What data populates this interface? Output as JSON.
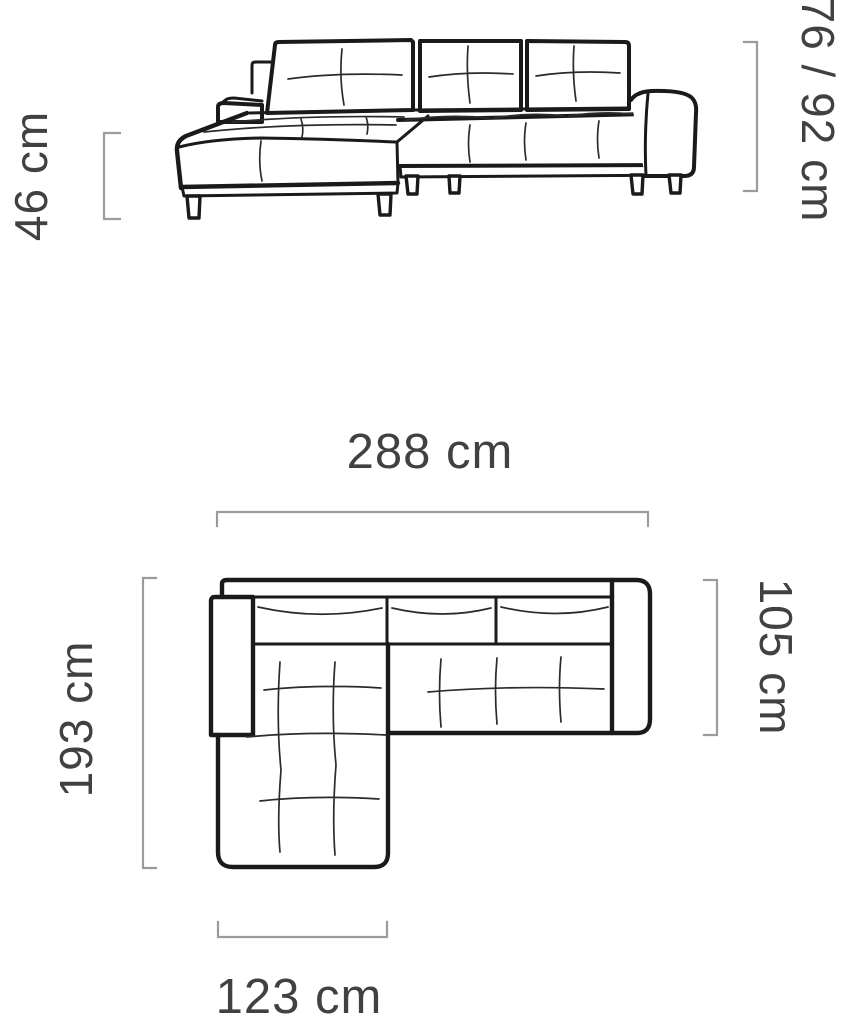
{
  "diagram": {
    "subject": "corner-sofa-dimension-diagram",
    "colors": {
      "line": "#1a1a1a",
      "dimension": "#9b9b9b",
      "text": "#414141",
      "background": "#ffffff"
    },
    "front_view": {
      "name": "front-elevation",
      "dimensions": [
        {
          "id": "seat_height",
          "label": "46 cm",
          "orientation": "vertical",
          "position": "left"
        },
        {
          "id": "back_height",
          "label": "76 / 92 cm",
          "orientation": "vertical",
          "position": "right"
        }
      ]
    },
    "plan_view": {
      "name": "top-plan",
      "dimensions": [
        {
          "id": "total_width",
          "label": "288 cm",
          "orientation": "horizontal",
          "position": "top"
        },
        {
          "id": "total_depth",
          "label": "193 cm",
          "orientation": "vertical",
          "position": "left"
        },
        {
          "id": "body_depth",
          "label": "105 cm",
          "orientation": "vertical",
          "position": "right"
        },
        {
          "id": "chaise_width",
          "label": "123 cm",
          "orientation": "horizontal",
          "position": "bottom"
        }
      ]
    }
  }
}
